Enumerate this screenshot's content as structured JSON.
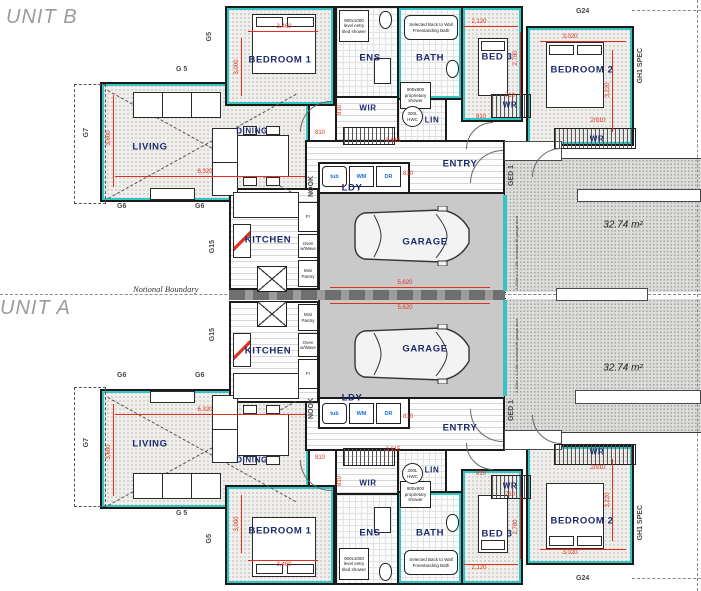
{
  "plan": {
    "unit_b": "UNIT B",
    "unit_a": "UNIT A",
    "boundary": "Notional Boundary",
    "driveway_area": "32.74 m²"
  },
  "rooms": {
    "living": "LIVING",
    "dining": "DINING",
    "kitchen": "KITCHEN",
    "garage": "GARAGE",
    "ldy": "LDY",
    "entry": "ENTRY",
    "nook": "NOOK",
    "bedroom1": "BEDROOM 1",
    "ens": "ENS",
    "bath": "BATH",
    "wir": "WIR",
    "lin": "LIN",
    "bed3": "BED 3",
    "bedroom2": "BEDROOM 2",
    "wr": "WR"
  },
  "fixtures": {
    "ens_shower": "900x1000 level entry tiled shower",
    "bath_note": "Selected Back to Wall Freestanding Bath",
    "shower900": "900x900 proprietary shower",
    "hwc": "300L HWC",
    "fridge": "Fr",
    "oven": "Oven w/Wave",
    "pantry": "Mini Pantry",
    "tub": "tub",
    "wm": "WM",
    "dr": "DR",
    "garage_door": "2,400w x 2,140h sectional lift garage door"
  },
  "grids": {
    "g5": "G5",
    "g5s": "G 5",
    "g6": "G6",
    "g7": "G7",
    "g15": "G15",
    "g24": "G24",
    "ged1": "GED 1",
    "gh1": "GH1 SPEC"
  },
  "dims": {
    "d3460": "3,460",
    "d3000": "3,000",
    "d6320": "6,320",
    "d3600": "3,600",
    "d810": "810",
    "d5620": "5,620",
    "d2615": "2,615",
    "d710": "710",
    "d2910": "2/910",
    "d3020": "3,020",
    "d3220": "3,220",
    "d2120": "2,120",
    "d2780": "2,780"
  },
  "colors": {
    "wall": "#1b1b1b",
    "teal": "#33c4c4",
    "dim_red": "#e03020",
    "room_label": "#1c2a6e",
    "appliance_blue": "#1d6fe0",
    "garage_floor": "#c9c9c9"
  }
}
